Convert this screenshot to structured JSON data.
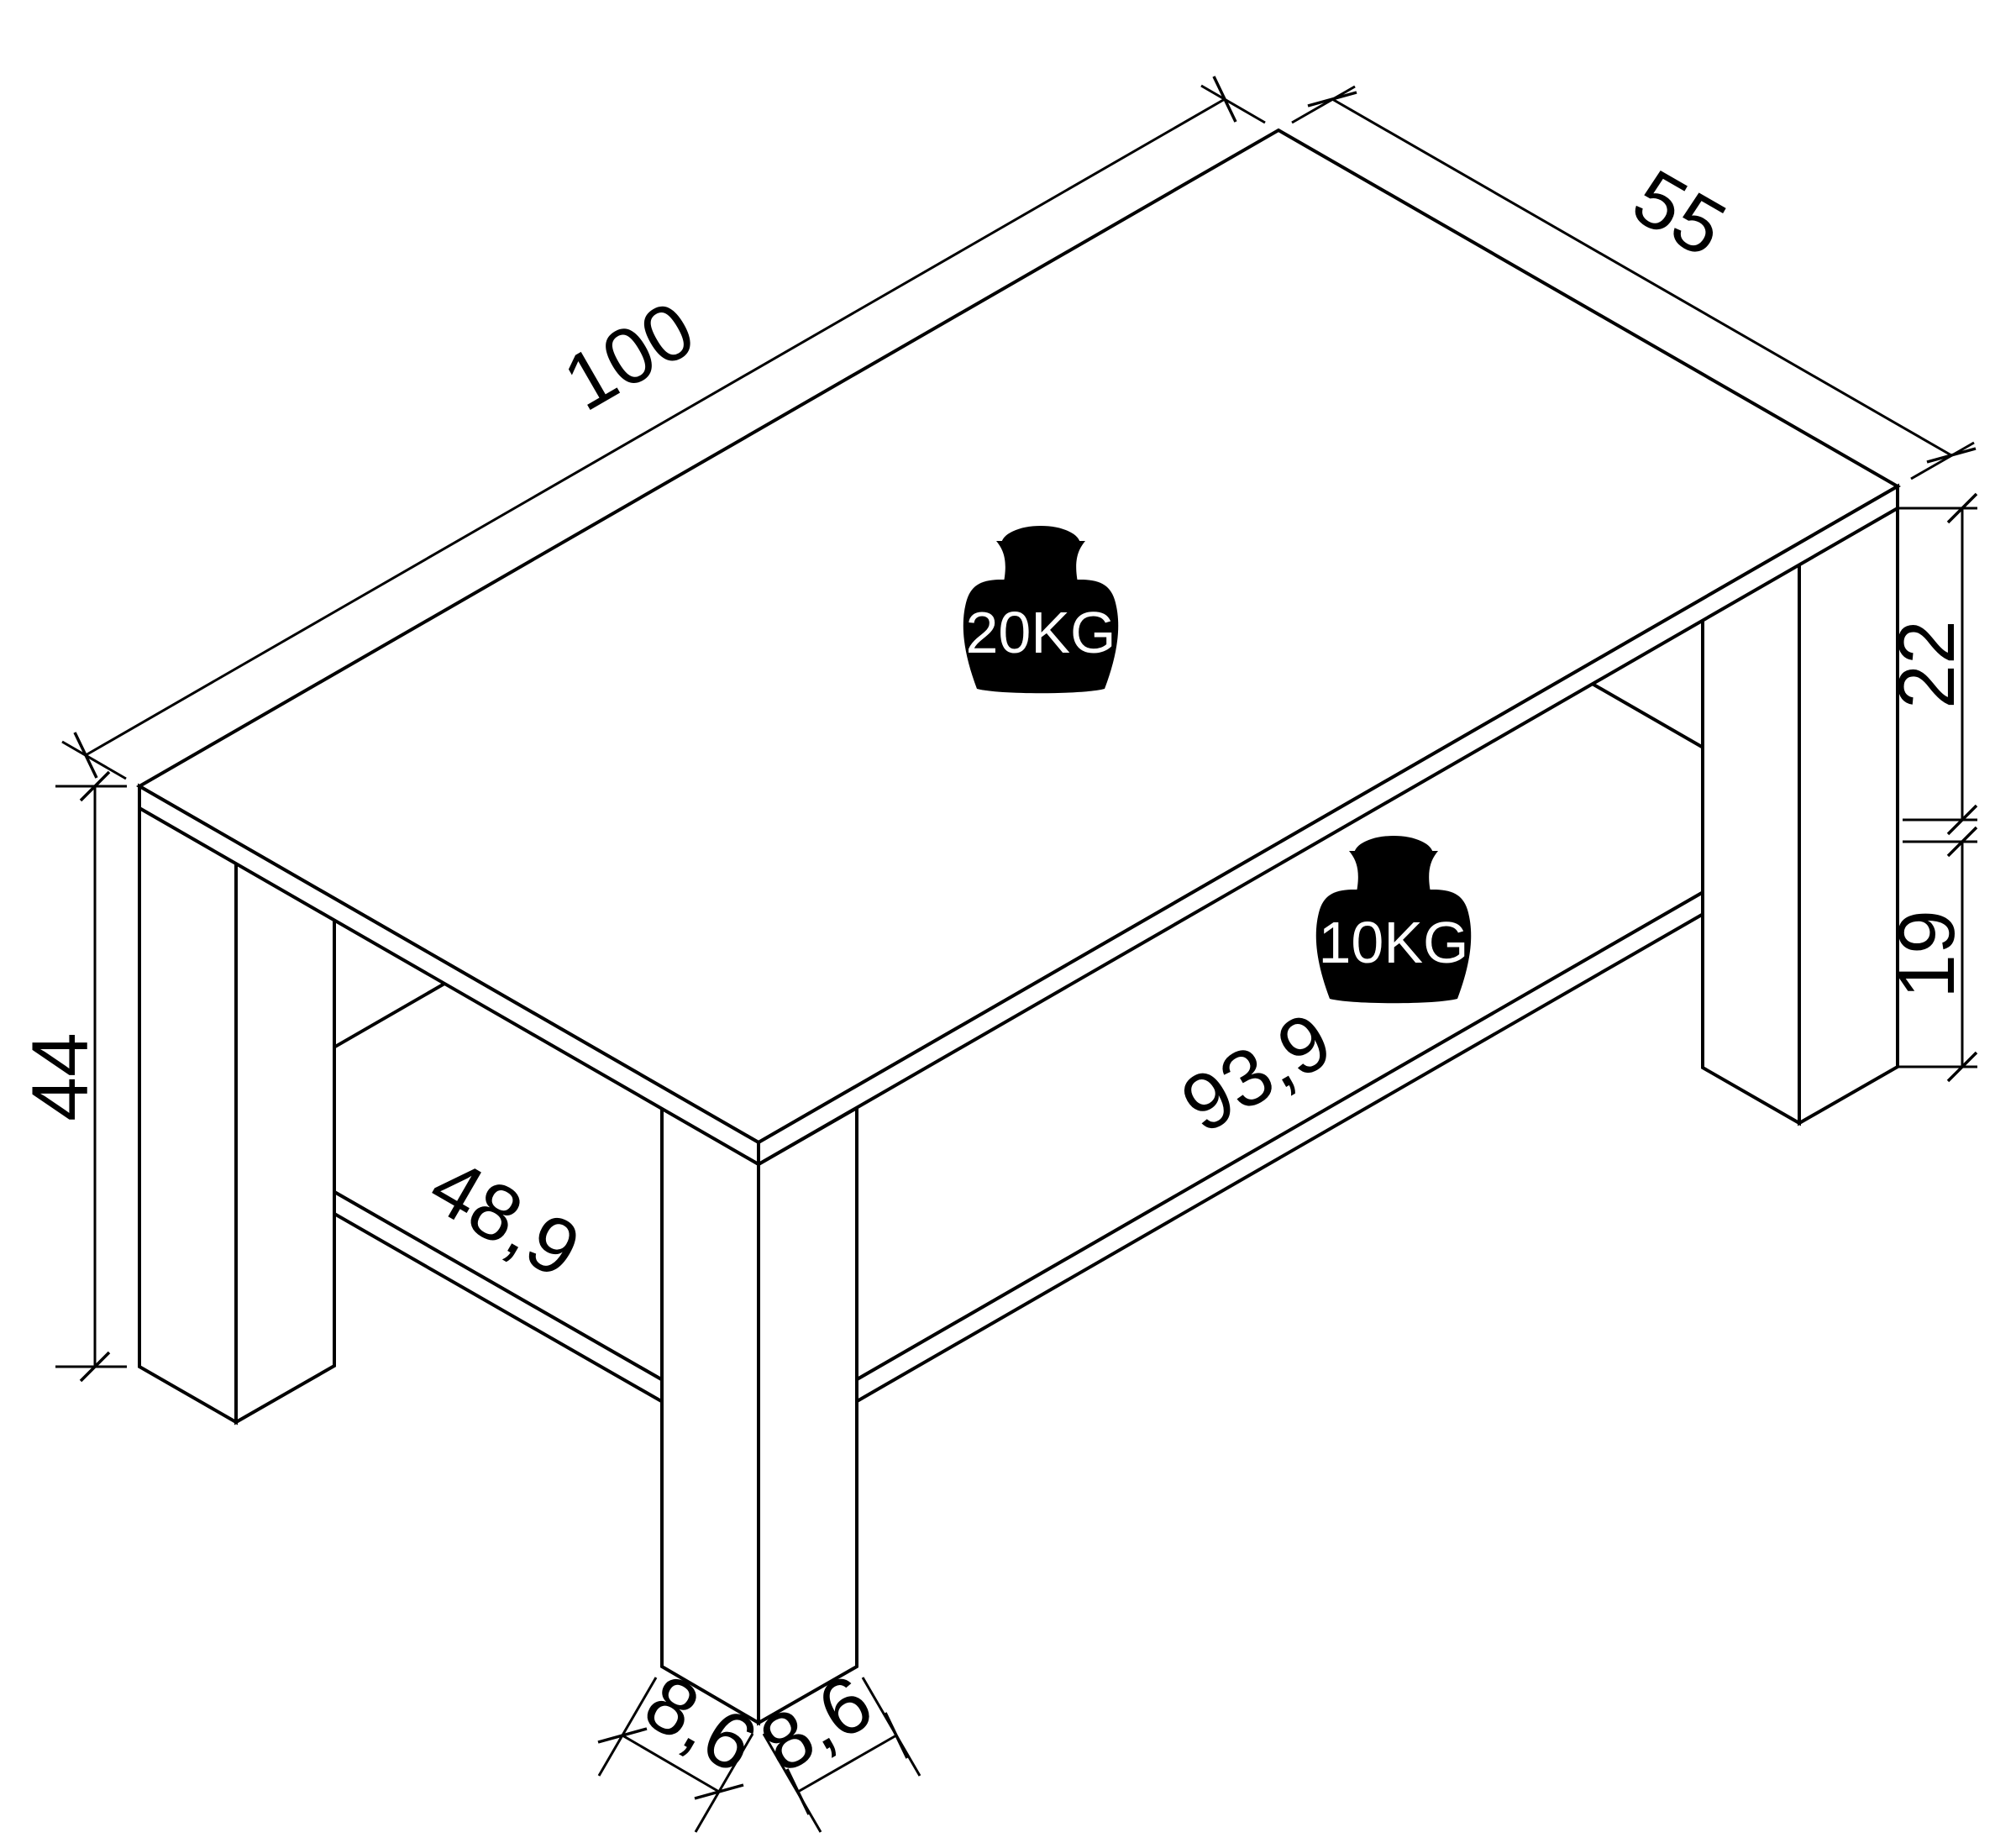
{
  "drawing": {
    "type": "isometric-furniture-dimension-drawing",
    "subject": "coffee-table-with-lower-shelf",
    "colors": {
      "line": "#000000",
      "background": "#ffffff",
      "weight_icon_fill": "#000000",
      "weight_icon_text": "#ffffff"
    },
    "dims": {
      "width": {
        "label": "100"
      },
      "depth": {
        "label": "55"
      },
      "clearance": {
        "label": "22"
      },
      "under_shelf": {
        "label": "19"
      },
      "height": {
        "label": "44"
      },
      "shelf_depth": {
        "label": "48,9"
      },
      "shelf_width": {
        "label": "93,9"
      },
      "leg_left": {
        "label": "8,6"
      },
      "leg_right": {
        "label": "8,6"
      }
    },
    "loads": {
      "tabletop": {
        "label": "20KG"
      },
      "shelf": {
        "label": "10KG"
      }
    }
  }
}
